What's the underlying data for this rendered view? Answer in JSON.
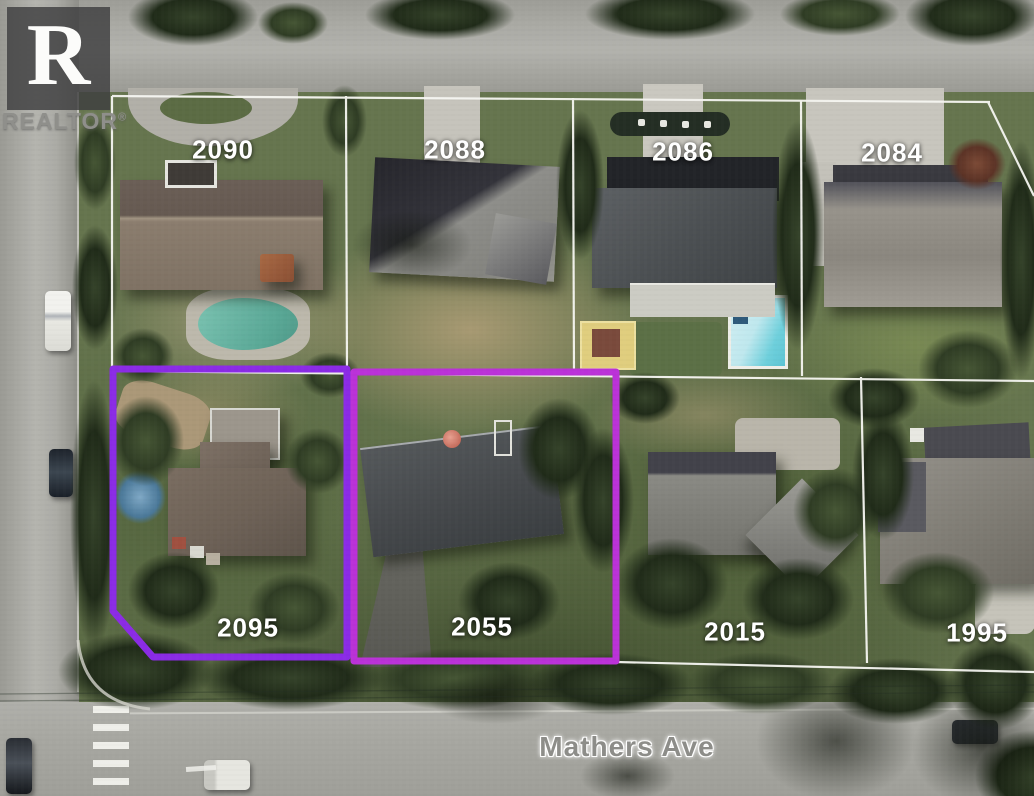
{
  "branding": {
    "logo_letter": "R",
    "wordmark": "REALTOR",
    "registered_mark": "®"
  },
  "street": {
    "name": "Mathers Ave"
  },
  "parcels": {
    "north_row": [
      {
        "lot": "2090",
        "highlighted": false
      },
      {
        "lot": "2088",
        "highlighted": false
      },
      {
        "lot": "2086",
        "highlighted": false
      },
      {
        "lot": "2084",
        "highlighted": false
      }
    ],
    "south_row": [
      {
        "lot": "2095",
        "highlighted": true
      },
      {
        "lot": "2055",
        "highlighted": true
      },
      {
        "lot": "2015",
        "highlighted": false
      },
      {
        "lot": "1995",
        "highlighted": false
      }
    ]
  },
  "colors": {
    "boundary": "#f7f7f2",
    "highlight_2095": "#8b2be6",
    "highlight_2055": "#bb32d8"
  }
}
